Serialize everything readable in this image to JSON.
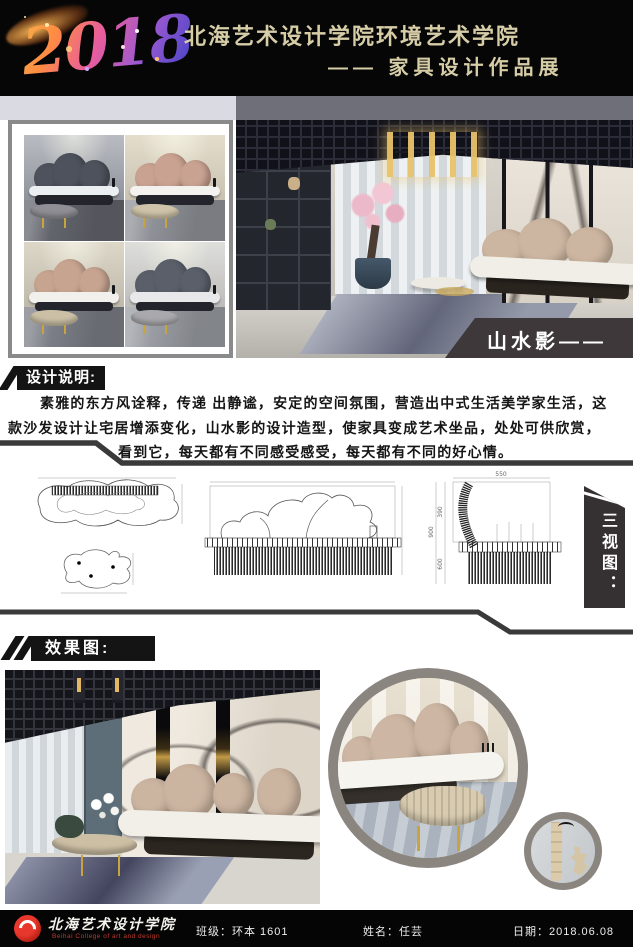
{
  "header": {
    "year": "2018",
    "school_line": "北海艺术设计学院环境艺术学院",
    "subtitle": "—— 家具设计作品展"
  },
  "main_render": {
    "banner": "山水影——"
  },
  "design_notes": {
    "label": "设计说明:",
    "line1": "素雅的东方风诠释，传递 出静谧，安定的空间氛围，营造出中式生活美学家生活，这",
    "line2": "款沙发设计让宅居增添变化，山水影的设计造型，使家具变成艺术坐品，处处可供欣赏，",
    "line3": "看到它，每天都有不同感受感受，每天都有不同的好心情。"
  },
  "three_views": {
    "label": "三视图：",
    "dims": {
      "width_top": "550",
      "height_upper": "390",
      "height_lower": "600",
      "height_total": "900"
    }
  },
  "effects": {
    "label": "效果图:"
  },
  "footer": {
    "school_name": "北海艺术设计学院",
    "school_name_en": "Beihai College of art and design",
    "class_label": "班级：",
    "class_value": "环本 1601",
    "name_label": "姓名：",
    "name_value": "任芸",
    "date_label": "日期：",
    "date_value": "2018.06.08"
  },
  "colors": {
    "header_text": "#d6cda7",
    "banner_dark": "#3e3839",
    "accent_red": "#d42a1e"
  }
}
